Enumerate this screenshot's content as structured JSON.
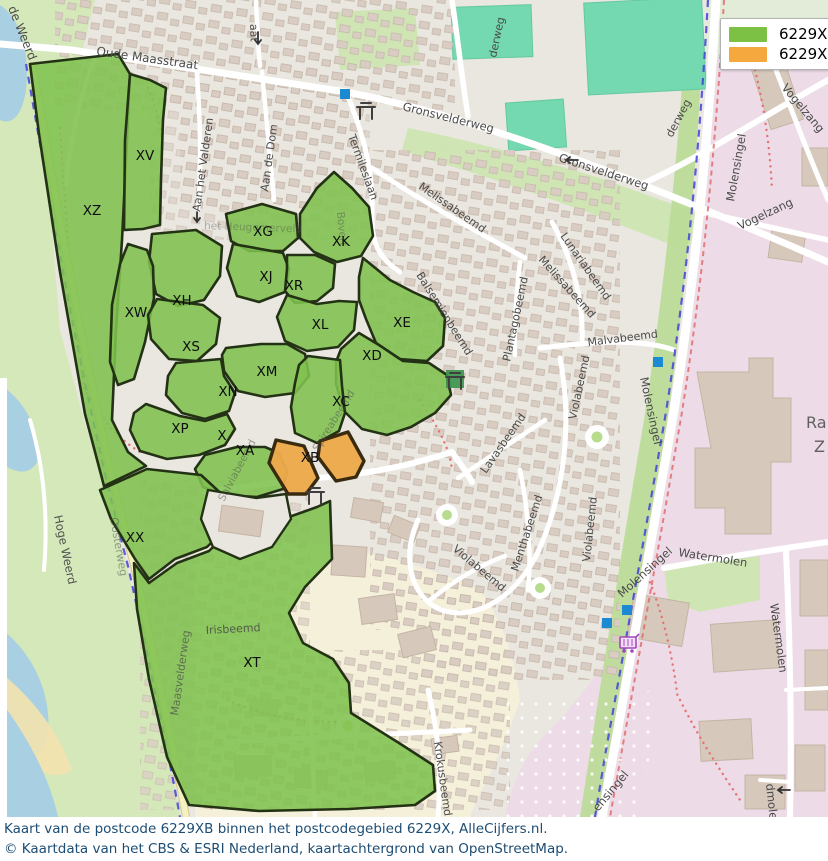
{
  "legend": {
    "items": [
      {
        "label": "6229X",
        "color": "#7cc143"
      },
      {
        "label": "6229XB",
        "color": "#f5a83e"
      }
    ]
  },
  "caption": {
    "line1": "Kaart van de postcode 6229XB binnen het postcodegebied 6229X, AlleCijfers.nl.",
    "line2": "© Kaartdata van het CBS & ESRI Nederland, kaartachtergrond van OpenStreetMap."
  },
  "map": {
    "highlight_code": "XB",
    "colors": {
      "region_green": "#7fc24e",
      "region_orange": "#eda94b",
      "region_border": "#233214",
      "water": "#a9cfe2",
      "pink_landuse": "#eddce7",
      "sports_pitch": "#74d9b0",
      "transit_marker_blue": "#1b8ad2",
      "cycle_route_blue": "#4242da",
      "footpath_red": "#e57373",
      "caption_text": "#1d4d74"
    },
    "regions": [
      {
        "code": "XV",
        "x": 145,
        "y": 160
      },
      {
        "code": "XZ",
        "x": 92,
        "y": 215
      },
      {
        "code": "XG",
        "x": 263,
        "y": 236
      },
      {
        "code": "XK",
        "x": 341,
        "y": 246
      },
      {
        "code": "XJ",
        "x": 266,
        "y": 281
      },
      {
        "code": "XR",
        "x": 294,
        "y": 290
      },
      {
        "code": "XH",
        "x": 182,
        "y": 305
      },
      {
        "code": "XW",
        "x": 136,
        "y": 317
      },
      {
        "code": "XL",
        "x": 320,
        "y": 329
      },
      {
        "code": "XE",
        "x": 402,
        "y": 327
      },
      {
        "code": "XS",
        "x": 191,
        "y": 351
      },
      {
        "code": "XD",
        "x": 372,
        "y": 360
      },
      {
        "code": "XM",
        "x": 267,
        "y": 376
      },
      {
        "code": "XN",
        "x": 228,
        "y": 396
      },
      {
        "code": "XC",
        "x": 341,
        "y": 406
      },
      {
        "code": "XP",
        "x": 180,
        "y": 433
      },
      {
        "code": "X",
        "x": 222,
        "y": 440
      },
      {
        "code": "XA",
        "x": 245,
        "y": 455
      },
      {
        "code": "XB",
        "x": 310,
        "y": 462
      },
      {
        "code": "XX",
        "x": 135,
        "y": 542
      },
      {
        "code": "XT",
        "x": 252,
        "y": 667
      }
    ],
    "streets": [
      {
        "name": "Oude Maasstraat",
        "x": 96,
        "y": 55,
        "rot": 8,
        "size": 12
      },
      {
        "name": "de Weerd",
        "x": 8,
        "y": 8,
        "rot": 68,
        "size": 12
      },
      {
        "name": "aat",
        "x": 250,
        "y": 24,
        "rot": 88,
        "size": 11
      },
      {
        "name": "Aan het Valderen",
        "x": 200,
        "y": 212,
        "rot": -82,
        "size": 11
      },
      {
        "name": "Aan de Dom",
        "x": 268,
        "y": 192,
        "rot": -82,
        "size": 11
      },
      {
        "name": "Termileslaan",
        "x": 348,
        "y": 136,
        "rot": 70,
        "size": 11
      },
      {
        "name": "Gronsvelderweg",
        "x": 402,
        "y": 110,
        "rot": 14,
        "size": 11.5
      },
      {
        "name": "Gronsvelderweg",
        "x": 558,
        "y": 161,
        "rot": 18,
        "size": 11.5
      },
      {
        "name": "derweg",
        "x": 496,
        "y": 58,
        "rot": -78,
        "size": 11
      },
      {
        "name": "derweg",
        "x": 672,
        "y": 138,
        "rot": -62,
        "size": 11
      },
      {
        "name": "Vogelzang",
        "x": 781,
        "y": 88,
        "rot": 50,
        "size": 11.5
      },
      {
        "name": "Vogelzang",
        "x": 740,
        "y": 230,
        "rot": -25,
        "size": 11.5
      },
      {
        "name": "Molensingel",
        "x": 734,
        "y": 202,
        "rot": -80,
        "size": 11.5
      },
      {
        "name": "Molensingel",
        "x": 640,
        "y": 378,
        "rot": 78,
        "size": 11.5
      },
      {
        "name": "Molensingel",
        "x": 622,
        "y": 598,
        "rot": -42,
        "size": 11.5
      },
      {
        "name": "ensingel",
        "x": 598,
        "y": 812,
        "rot": -50,
        "size": 11.5
      },
      {
        "name": "Watermolen",
        "x": 678,
        "y": 556,
        "rot": 9,
        "size": 11.5
      },
      {
        "name": "Watermolen",
        "x": 770,
        "y": 604,
        "rot": 82,
        "size": 11.5
      },
      {
        "name": "dmolen",
        "x": 766,
        "y": 784,
        "rot": 84,
        "size": 11.5
      },
      {
        "name": "Melissabeemd",
        "x": 418,
        "y": 188,
        "rot": 35,
        "size": 11
      },
      {
        "name": "Melissabeemd",
        "x": 538,
        "y": 260,
        "rot": 48,
        "size": 11
      },
      {
        "name": "Lunariabeemd",
        "x": 560,
        "y": 236,
        "rot": 55,
        "size": 11
      },
      {
        "name": "Plantagobeemd",
        "x": 510,
        "y": 362,
        "rot": -78,
        "size": 11
      },
      {
        "name": "Malvabeemd",
        "x": 588,
        "y": 346,
        "rot": -7,
        "size": 11
      },
      {
        "name": "Balsemienbeemd",
        "x": 416,
        "y": 275,
        "rot": 58,
        "size": 11
      },
      {
        "name": "Violabeemd",
        "x": 576,
        "y": 420,
        "rot": -78,
        "size": 11
      },
      {
        "name": "Violabeemd",
        "x": 590,
        "y": 562,
        "rot": -84,
        "size": 11
      },
      {
        "name": "Violabeemd",
        "x": 452,
        "y": 550,
        "rot": 40,
        "size": 11
      },
      {
        "name": "Lavasbeemd",
        "x": 486,
        "y": 474,
        "rot": -55,
        "size": 11
      },
      {
        "name": "Menthabeemd",
        "x": 518,
        "y": 572,
        "rot": -72,
        "size": 11
      },
      {
        "name": "Krokusbeemd",
        "x": 434,
        "y": 742,
        "rot": 82,
        "size": 11
      },
      {
        "name": "Irisbeemd",
        "x": 206,
        "y": 634,
        "rot": -3,
        "size": 11,
        "op": 0.85
      },
      {
        "name": "Maasvelderweg",
        "x": 178,
        "y": 716,
        "rot": -82,
        "size": 11,
        "op": 0.7
      },
      {
        "name": "Oosterweg",
        "x": 110,
        "y": 518,
        "rot": 80,
        "size": 11,
        "op": 0.5
      },
      {
        "name": "Hoge Weerd",
        "x": 54,
        "y": 516,
        "rot": 78,
        "size": 11.5,
        "op": 0.95
      },
      {
        "name": "het Heugemerveld",
        "x": 204,
        "y": 229,
        "rot": 2,
        "size": 10.5,
        "op": 0.4
      },
      {
        "name": "Bovert",
        "x": 337,
        "y": 212,
        "rot": 85,
        "size": 10.5,
        "op": 0.45
      },
      {
        "name": "Salviabeemd",
        "x": 224,
        "y": 502,
        "rot": -62,
        "size": 10.5,
        "op": 0.5
      },
      {
        "name": "Spireabeemd",
        "x": 318,
        "y": 452,
        "rot": -58,
        "size": 10.5,
        "op": 0.5
      },
      {
        "name": "Ran",
        "x": 806,
        "y": 428,
        "rot": 0,
        "size": 16,
        "op": 0.85,
        "color": "#8b8189"
      },
      {
        "name": "Z",
        "x": 814,
        "y": 452,
        "rot": 0,
        "size": 16,
        "op": 0.85,
        "color": "#8b8189"
      }
    ],
    "markers": [
      {
        "type": "transit-stop",
        "x": 345,
        "y": 94
      },
      {
        "type": "transit-stop",
        "x": 658,
        "y": 362
      },
      {
        "type": "transit-stop",
        "x": 627,
        "y": 610
      },
      {
        "type": "transit-stop",
        "x": 607,
        "y": 623
      },
      {
        "type": "picnic-site",
        "x": 366,
        "y": 112
      },
      {
        "type": "picnic-site",
        "x": 455,
        "y": 382
      },
      {
        "type": "picnic-site",
        "x": 315,
        "y": 497
      },
      {
        "type": "supermarket-cart",
        "x": 628,
        "y": 645
      }
    ]
  }
}
